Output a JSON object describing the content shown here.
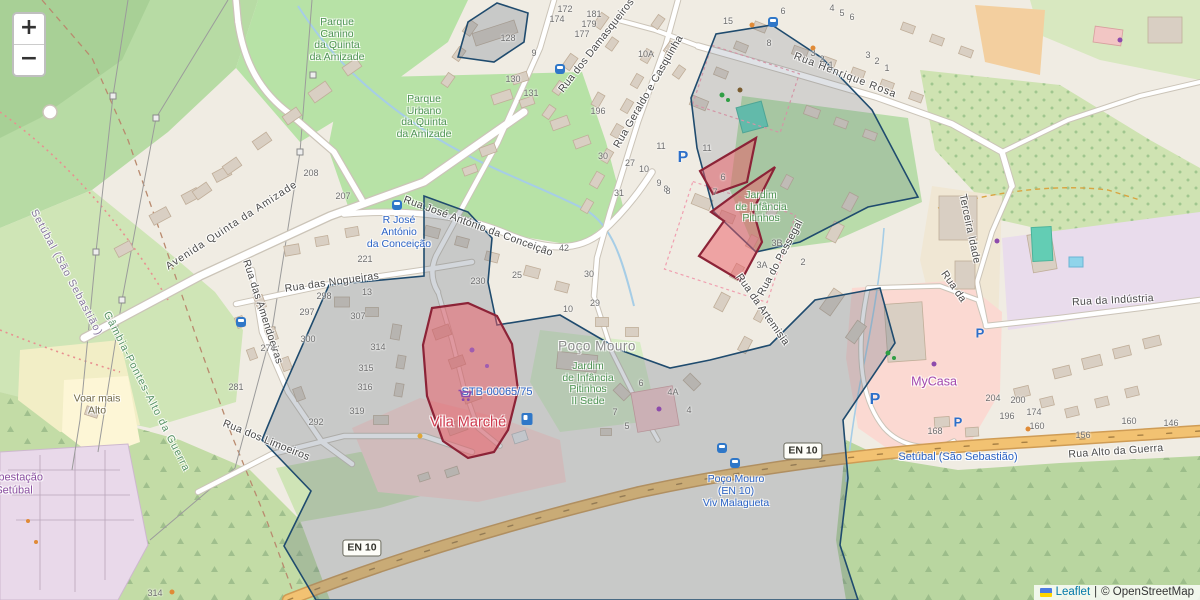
{
  "map": {
    "controls": {
      "zoom_in": "+",
      "zoom_out": "−"
    },
    "attribution": {
      "leaflet": "Leaflet",
      "separator": "|",
      "copyright": "© OpenStreetMap"
    }
  },
  "shields": [
    "EN 10",
    "EN 10"
  ],
  "streets": [
    "Avenida Quinta da Amizade",
    "Rua das Nogueiras",
    "Rua das Amendoeiras",
    "Rua dos Limoeiros",
    "Rua José António da Conceição",
    "Rua dos Damasqueiros",
    "Rua Geraldo e Casquinha",
    "Rua Henrique Rosa",
    "Rua da Artemisia",
    "Rua do Pessegal",
    "Terceira Idade",
    "Rua da",
    "Rua da Indústria",
    "Rua Alto da Guerra"
  ],
  "boundaries": [
    "Setúbal (São Sebastião)",
    "Gâmbia-Pontes-Alto da Guerra"
  ],
  "places": {
    "parque_canino": "Parque\nCanino\nda Quinta\nda Amizade",
    "parque_urbano": "Parque\nUrbano\nda Quinta\nda Amizade",
    "jardim_sede": "Jardim\nde Infância\nPitinhos\nII Sede",
    "jardim": "Jardim\nde Infância\nPitinhos",
    "poco_mouro": "Poço Mouro",
    "vila_marche": "Vila Marché",
    "stb_ref": "STB-00065/75",
    "mycasa": "MyCasa",
    "voar": "Voar mais\nAlto",
    "subestacao": "Subestação\nSetúbal"
  },
  "transit": {
    "stop_rjac": "R José\nAntónio\nda Conceição",
    "stop_poco": "Poço Mouro\n(EN 10)\nViv Malagueta",
    "station": "Setúbal (São Sebastião)"
  },
  "icons": {
    "parking_label": "P"
  },
  "housenumbers": [
    {
      "t": "128",
      "x": 508,
      "y": 38
    },
    {
      "t": "9",
      "x": 534,
      "y": 53
    },
    {
      "t": "130",
      "x": 513,
      "y": 79
    },
    {
      "t": "131",
      "x": 531,
      "y": 93
    },
    {
      "t": "196",
      "x": 598,
      "y": 111
    },
    {
      "t": "172",
      "x": 565,
      "y": 9
    },
    {
      "t": "174",
      "x": 557,
      "y": 19
    },
    {
      "t": "181",
      "x": 594,
      "y": 14
    },
    {
      "t": "179",
      "x": 589,
      "y": 24
    },
    {
      "t": "177",
      "x": 582,
      "y": 34
    },
    {
      "t": "10A",
      "x": 646,
      "y": 54
    },
    {
      "t": "30",
      "x": 603,
      "y": 156
    },
    {
      "t": "27",
      "x": 630,
      "y": 163
    },
    {
      "t": "31",
      "x": 619,
      "y": 193
    },
    {
      "t": "10",
      "x": 644,
      "y": 169
    },
    {
      "t": "11",
      "x": 661,
      "y": 146
    },
    {
      "t": "9",
      "x": 659,
      "y": 183
    },
    {
      "t": "8",
      "x": 666,
      "y": 189
    },
    {
      "t": "15",
      "x": 728,
      "y": 21
    },
    {
      "t": "6",
      "x": 783,
      "y": 11
    },
    {
      "t": "8",
      "x": 769,
      "y": 43
    },
    {
      "t": "3",
      "x": 813,
      "y": 53
    },
    {
      "t": "2",
      "x": 822,
      "y": 59
    },
    {
      "t": "1",
      "x": 831,
      "y": 65
    },
    {
      "t": "3",
      "x": 868,
      "y": 55
    },
    {
      "t": "2",
      "x": 877,
      "y": 61
    },
    {
      "t": "1",
      "x": 887,
      "y": 68
    },
    {
      "t": "4",
      "x": 832,
      "y": 8
    },
    {
      "t": "5",
      "x": 842,
      "y": 13
    },
    {
      "t": "6",
      "x": 852,
      "y": 17
    },
    {
      "t": "208",
      "x": 311,
      "y": 173
    },
    {
      "t": "207",
      "x": 343,
      "y": 196
    },
    {
      "t": "221",
      "x": 365,
      "y": 259
    },
    {
      "t": "13",
      "x": 367,
      "y": 292
    },
    {
      "t": "298",
      "x": 324,
      "y": 296
    },
    {
      "t": "297",
      "x": 307,
      "y": 312
    },
    {
      "t": "300",
      "x": 308,
      "y": 339
    },
    {
      "t": "274",
      "x": 268,
      "y": 348
    },
    {
      "t": "281",
      "x": 236,
      "y": 387
    },
    {
      "t": "307",
      "x": 358,
      "y": 316
    },
    {
      "t": "314",
      "x": 378,
      "y": 347
    },
    {
      "t": "315",
      "x": 366,
      "y": 368
    },
    {
      "t": "316",
      "x": 365,
      "y": 387
    },
    {
      "t": "319",
      "x": 357,
      "y": 411
    },
    {
      "t": "292",
      "x": 316,
      "y": 422
    },
    {
      "t": "230",
      "x": 478,
      "y": 281
    },
    {
      "t": "25",
      "x": 517,
      "y": 275
    },
    {
      "t": "42",
      "x": 564,
      "y": 248
    },
    {
      "t": "30",
      "x": 589,
      "y": 274
    },
    {
      "t": "29",
      "x": 595,
      "y": 303
    },
    {
      "t": "10",
      "x": 568,
      "y": 309
    },
    {
      "t": "11",
      "x": 707,
      "y": 148
    },
    {
      "t": "6",
      "x": 723,
      "y": 177
    },
    {
      "t": "7",
      "x": 715,
      "y": 192
    },
    {
      "t": "8",
      "x": 668,
      "y": 191
    },
    {
      "t": "3B",
      "x": 777,
      "y": 243
    },
    {
      "t": "3A",
      "x": 762,
      "y": 265
    },
    {
      "t": "2",
      "x": 803,
      "y": 262
    },
    {
      "t": "6",
      "x": 641,
      "y": 383
    },
    {
      "t": "4A",
      "x": 673,
      "y": 392
    },
    {
      "t": "4",
      "x": 689,
      "y": 410
    },
    {
      "t": "7",
      "x": 615,
      "y": 412
    },
    {
      "t": "5",
      "x": 627,
      "y": 426
    },
    {
      "t": "204",
      "x": 993,
      "y": 398
    },
    {
      "t": "200",
      "x": 1018,
      "y": 400
    },
    {
      "t": "196",
      "x": 1007,
      "y": 416
    },
    {
      "t": "174",
      "x": 1034,
      "y": 412
    },
    {
      "t": "168",
      "x": 935,
      "y": 431
    },
    {
      "t": "160",
      "x": 1037,
      "y": 426
    },
    {
      "t": "160",
      "x": 1129,
      "y": 421
    },
    {
      "t": "156",
      "x": 1083,
      "y": 435
    },
    {
      "t": "146",
      "x": 1171,
      "y": 423
    },
    {
      "t": "314",
      "x": 155,
      "y": 593
    }
  ],
  "overlay_colors": {
    "blue_stroke": "#1f4b6e",
    "blue_fill": "rgba(96,110,130,0.28)",
    "red_stroke": "#8c2337",
    "red_fill": "rgba(235,90,100,0.5)"
  }
}
